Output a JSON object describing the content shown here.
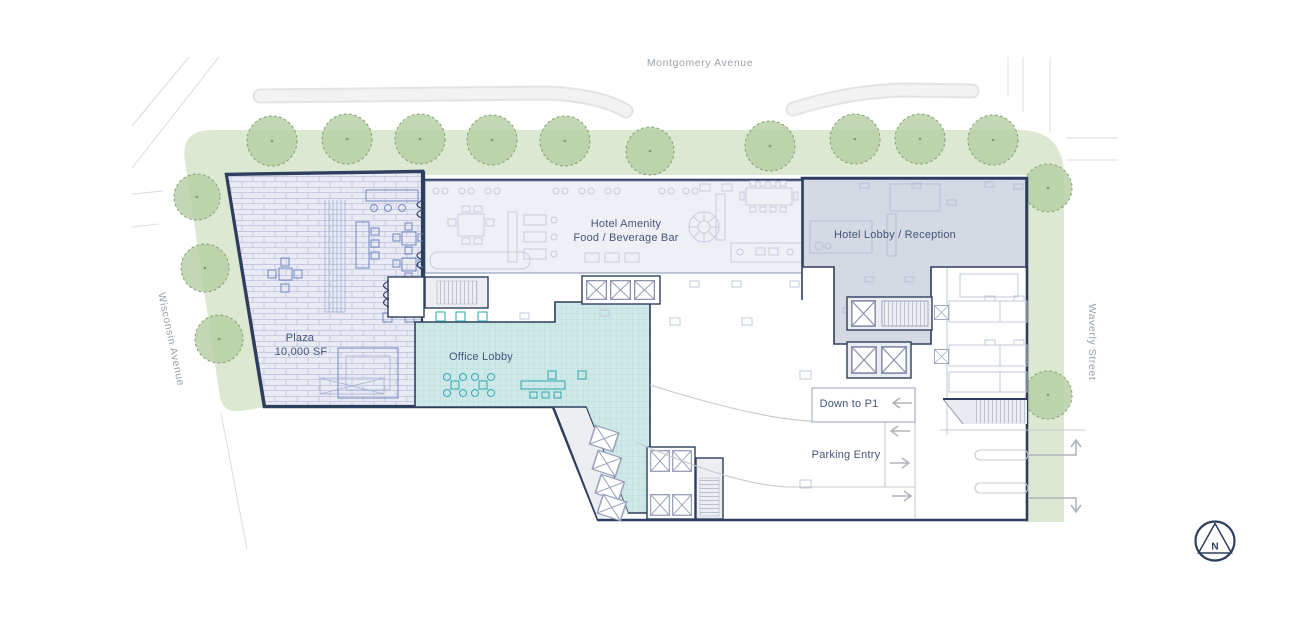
{
  "plan": {
    "streets": {
      "montgomery": "Montgomery Avenue",
      "wisconsin": "Wisconsin Avenue",
      "waverly": "Waverly Street"
    },
    "areas": {
      "plaza_name": "Plaza",
      "plaza_area": "10,000 SF",
      "hotel_amenity_line1": "Hotel Amenity",
      "hotel_amenity_line2": "Food / Beverage Bar",
      "hotel_lobby": "Hotel Lobby / Reception",
      "office_lobby": "Office Lobby",
      "down_to_p1": "Down to P1",
      "parking_entry": "Parking Entry"
    },
    "compass_label": "N"
  },
  "site": {
    "trees": [
      {
        "x": 272,
        "y": 141,
        "r": 25
      },
      {
        "x": 347,
        "y": 139,
        "r": 25
      },
      {
        "x": 420,
        "y": 139,
        "r": 25
      },
      {
        "x": 492,
        "y": 140,
        "r": 25
      },
      {
        "x": 565,
        "y": 141,
        "r": 25
      },
      {
        "x": 650,
        "y": 151,
        "r": 24
      },
      {
        "x": 770,
        "y": 146,
        "r": 25
      },
      {
        "x": 855,
        "y": 139,
        "r": 25
      },
      {
        "x": 920,
        "y": 139,
        "r": 25
      },
      {
        "x": 993,
        "y": 140,
        "r": 25
      },
      {
        "x": 1048,
        "y": 188,
        "r": 24
      },
      {
        "x": 197,
        "y": 197,
        "r": 23
      },
      {
        "x": 205,
        "y": 268,
        "r": 24
      },
      {
        "x": 219,
        "y": 339,
        "r": 24
      },
      {
        "x": 1048,
        "y": 395,
        "r": 24
      }
    ]
  },
  "colors": {
    "outline_navy": "#2e3e5e",
    "label_navy": "#44547a",
    "street_label_gray": "#9aa0a8",
    "green_band": "#dce8d1",
    "tree_green": "#b5cfa3",
    "tree_edge": "#7f9e6d",
    "plaza_fill": "#e9eaf3",
    "plaza_pattern_line": "#b7bed9",
    "plaza_furniture": "#7288c2",
    "amenity_fill": "#eff0f5",
    "amenity_furniture": "#c6cbdc",
    "hotel_lobby_fill": "#d4d9e4",
    "office_lobby_fill": "#cfe9e9",
    "office_grid": "#a9d4d4",
    "office_furniture": "#3aacb2",
    "road_fill": "#f2f2f2",
    "road_edge": "#e3e3e3",
    "drive_line": "#c5c9d2",
    "arrow_gray": "#b0b4bc"
  }
}
